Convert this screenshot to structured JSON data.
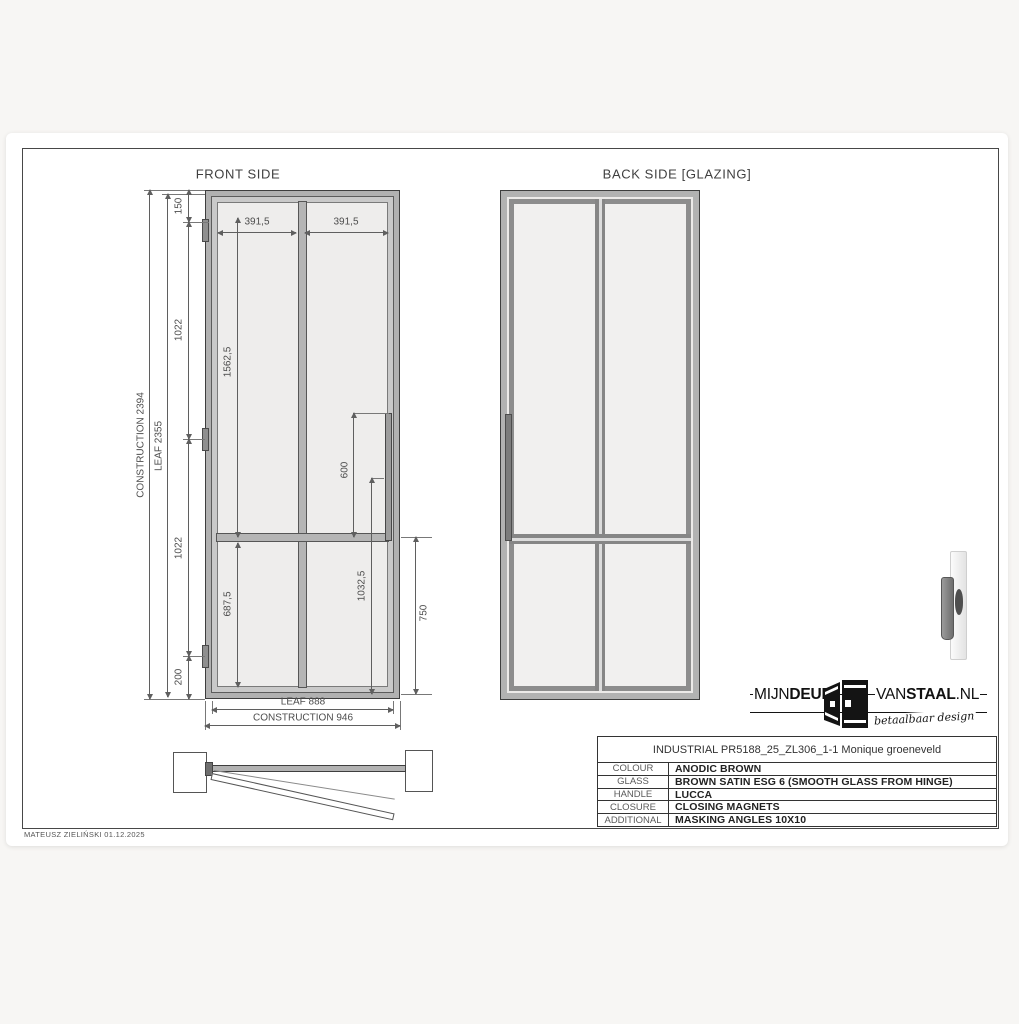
{
  "front_view": {
    "title": "FRONT SIDE",
    "dims": {
      "construction_height": "CONSTRUCTION 2394",
      "leaf_height": "LEAF 2355",
      "seg_top": "150",
      "seg_upper": "1022",
      "seg_lower": "1022",
      "seg_bottom": "200",
      "glass_upper_height": "1562,5",
      "glass_lower_height": "687,5",
      "handle_to_mullion": "600",
      "handle_from_bottom": "1032,5",
      "lower_panel_right": "750",
      "panel_width_left": "391,5",
      "panel_width_right": "391,5",
      "leaf_width": "LEAF 888",
      "construction_width": "CONSTRUCTION 946"
    }
  },
  "back_view": {
    "title": "BACK SIDE [GLAZING]"
  },
  "logo": {
    "mijn": "MIJN",
    "deur": "DEUR",
    "van": "VAN",
    "staal": "STAAL",
    "nl": ".NL",
    "tagline": "betaalbaar design"
  },
  "title_block": {
    "header": "INDUSTRIAL PR5188_25_ZL306_1-1 Monique groeneveld",
    "rows": [
      {
        "label": "COLOUR",
        "value": "ANODIC BROWN"
      },
      {
        "label": "GLASS",
        "value": "BROWN SATIN ESG 6 (SMOOTH GLASS FROM HINGE)"
      },
      {
        "label": "HANDLE",
        "value": "LUCCA"
      },
      {
        "label": "CLOSURE",
        "value": "CLOSING MAGNETS"
      },
      {
        "label": "ADDITIONAL",
        "value": "MASKING ANGLES 10X10"
      }
    ]
  },
  "footer": {
    "author": "MATEUSZ ZIELIŃSKI 01.12.2025"
  },
  "colors": {
    "frame_fill": "#b1b1b1",
    "leaf_fill": "#c9c9c9",
    "glass_fill": "#eeedec",
    "outline": "#3e3e3e",
    "dimension": "#4d4d4d"
  }
}
